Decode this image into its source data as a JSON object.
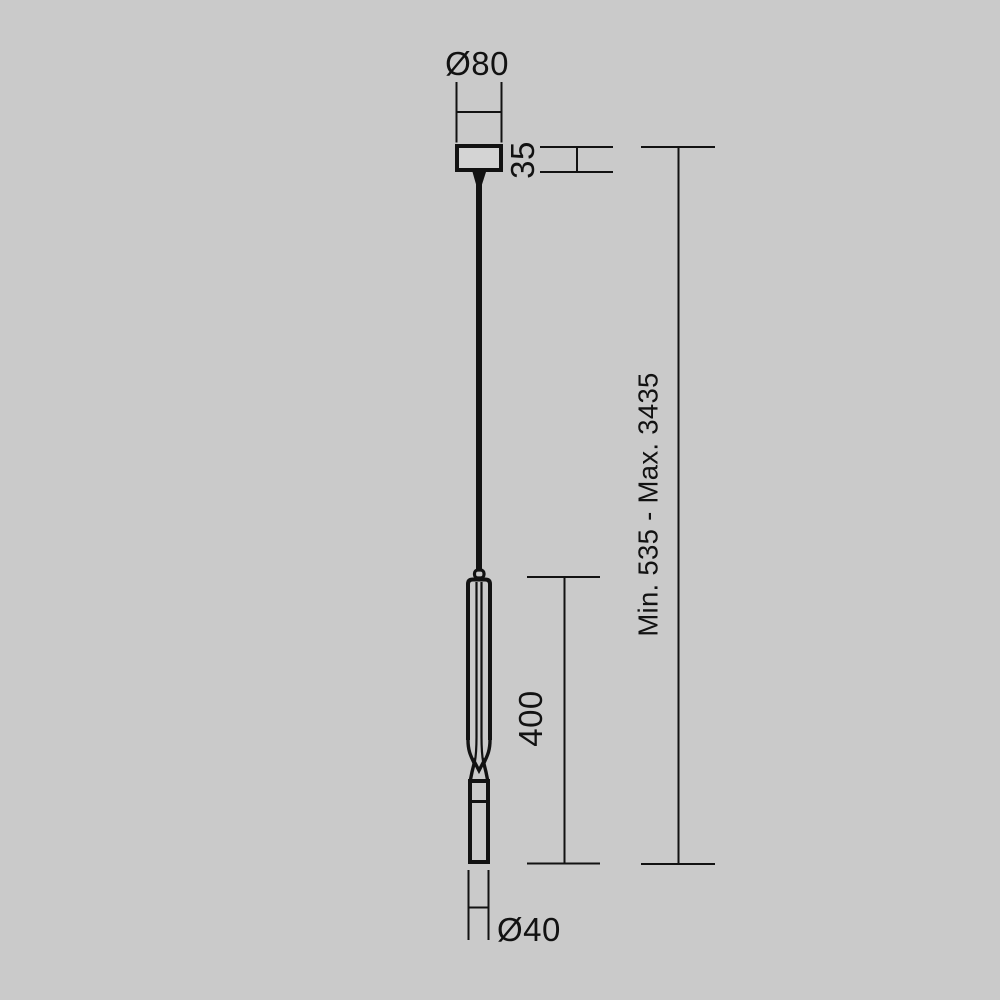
{
  "page": {
    "background_color": "#cacaca",
    "line_color": "#121212",
    "canopy_fill_color": "#d4d4d4"
  },
  "diagram": {
    "kind": "pendant-lamp-technical-dimension-drawing",
    "labels": {
      "canopy_diameter": "Ø80",
      "canopy_height": "35",
      "lamp_body_length": "400",
      "lamp_body_diameter": "Ø40",
      "suspension_range": "Min. 535 - Max. 3435"
    }
  }
}
